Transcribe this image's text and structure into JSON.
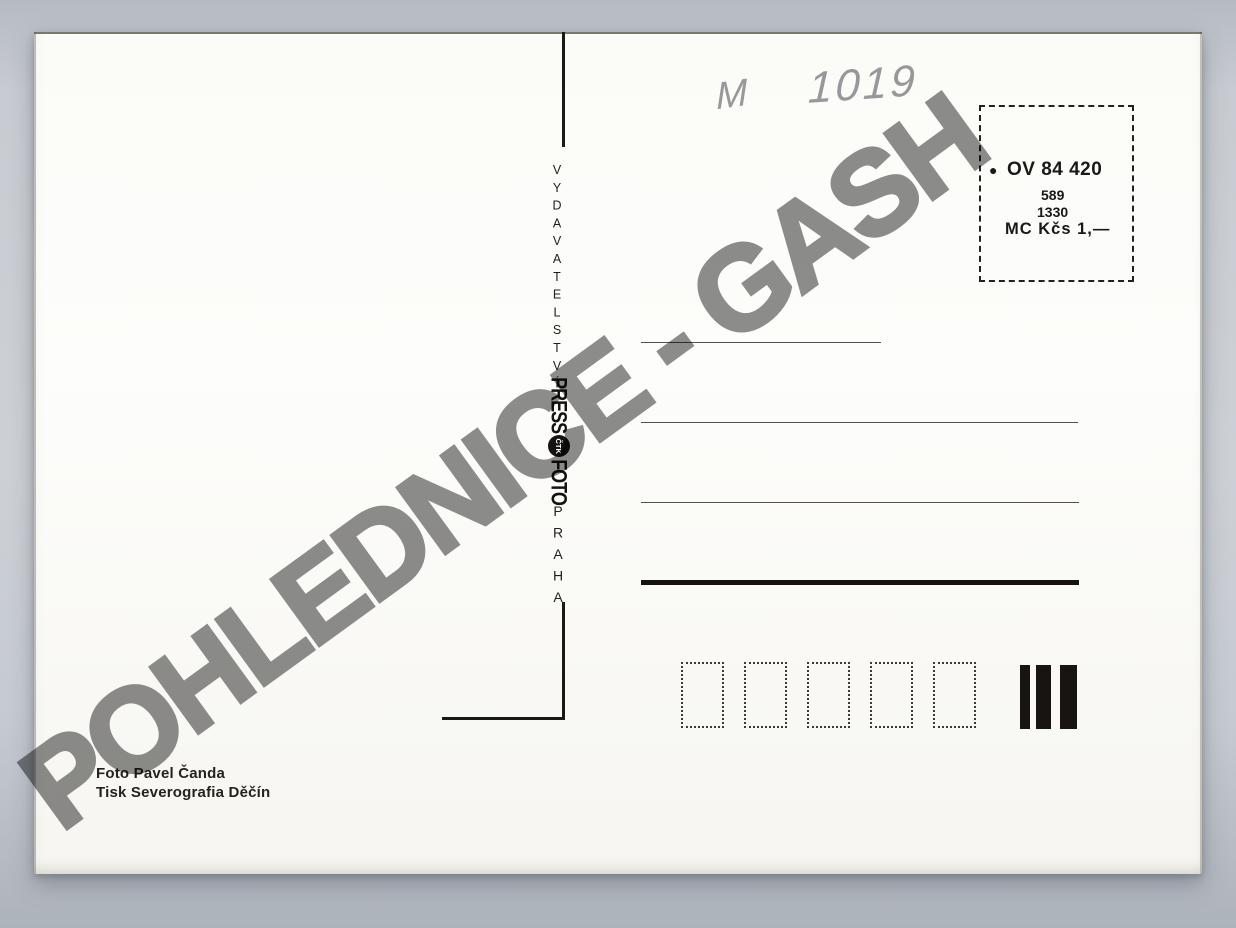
{
  "scene": {
    "description": "scanned back of blank Czechoslovak postcard",
    "background_color": "#cdd1d6",
    "paper_color": "#fcfcf9",
    "ink_color": "#1b1917"
  },
  "handwriting": {
    "prefix": "M",
    "number": "1019",
    "pencil_color": "#98989a"
  },
  "publisher_column": {
    "vertical_text": "VYDAVATELSTVÍ",
    "logo": {
      "press": "PRESS",
      "emblem": "ČTK",
      "foto": "FOTO"
    },
    "city": "PRAHA"
  },
  "stamp_box": {
    "bullet": "●",
    "code": "OV 84 420",
    "edition": "589",
    "number": "1330",
    "price": "MC Kčs 1,—"
  },
  "address_area": {
    "thin_lines": 3,
    "thick_lines": 1
  },
  "postal_code_boxes": {
    "count": 5
  },
  "sorting_bars": {
    "count": 3
  },
  "credits": {
    "photo": "Foto Pavel Čanda",
    "print": "Tisk Severografia Děčín"
  },
  "watermark": {
    "text": "POHLEDNICE - GASH",
    "color": "#8d8d8d"
  }
}
